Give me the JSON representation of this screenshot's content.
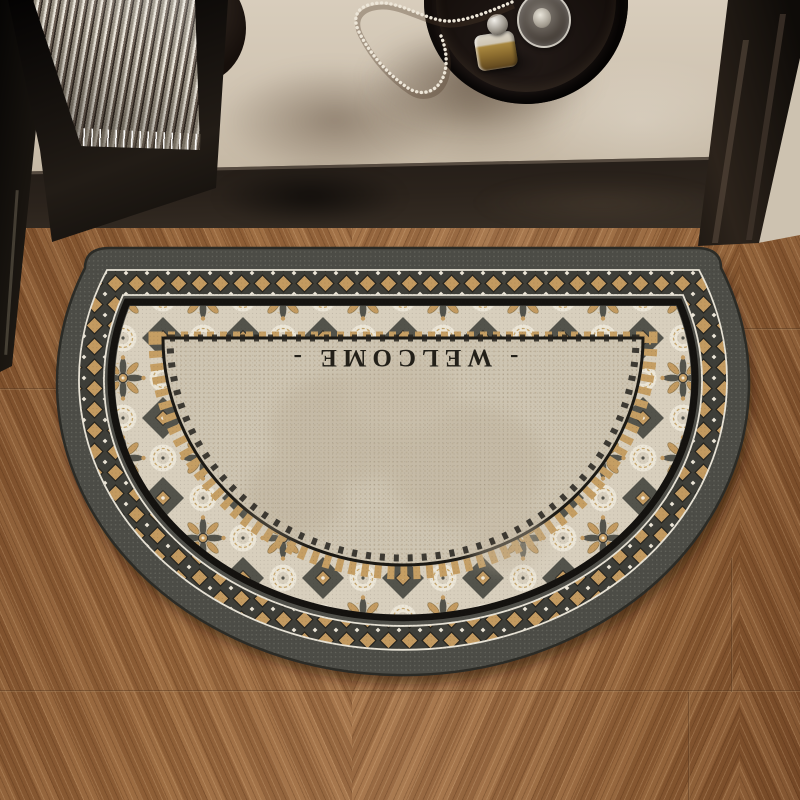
{
  "mat": {
    "welcome_text": "- WELCOME -",
    "shape": "semicircle",
    "colors": {
      "rubber_band": "#4c4c46",
      "diamond_tan": "#c39a60",
      "tile_cream": "#d8cfbd",
      "tile_dark": "#53534b",
      "inner_field": "#cec5b2",
      "text": "#232019",
      "accent_white": "#ece6d8",
      "border_black": "#14120f"
    }
  },
  "scene": {
    "floor_wood": "#96653b",
    "interior_floor": "#cfc3b1",
    "wall": "#d5ccbb",
    "threshold": "#171310",
    "objects": {
      "tray": "round-black-tray",
      "perfume_bottle": "amber-perfume-bottle",
      "glass_candlestick": "glass-candlestick",
      "necklace": "pearl-necklace",
      "door": "fluted-glass-door",
      "vase": "dark-vase"
    }
  }
}
